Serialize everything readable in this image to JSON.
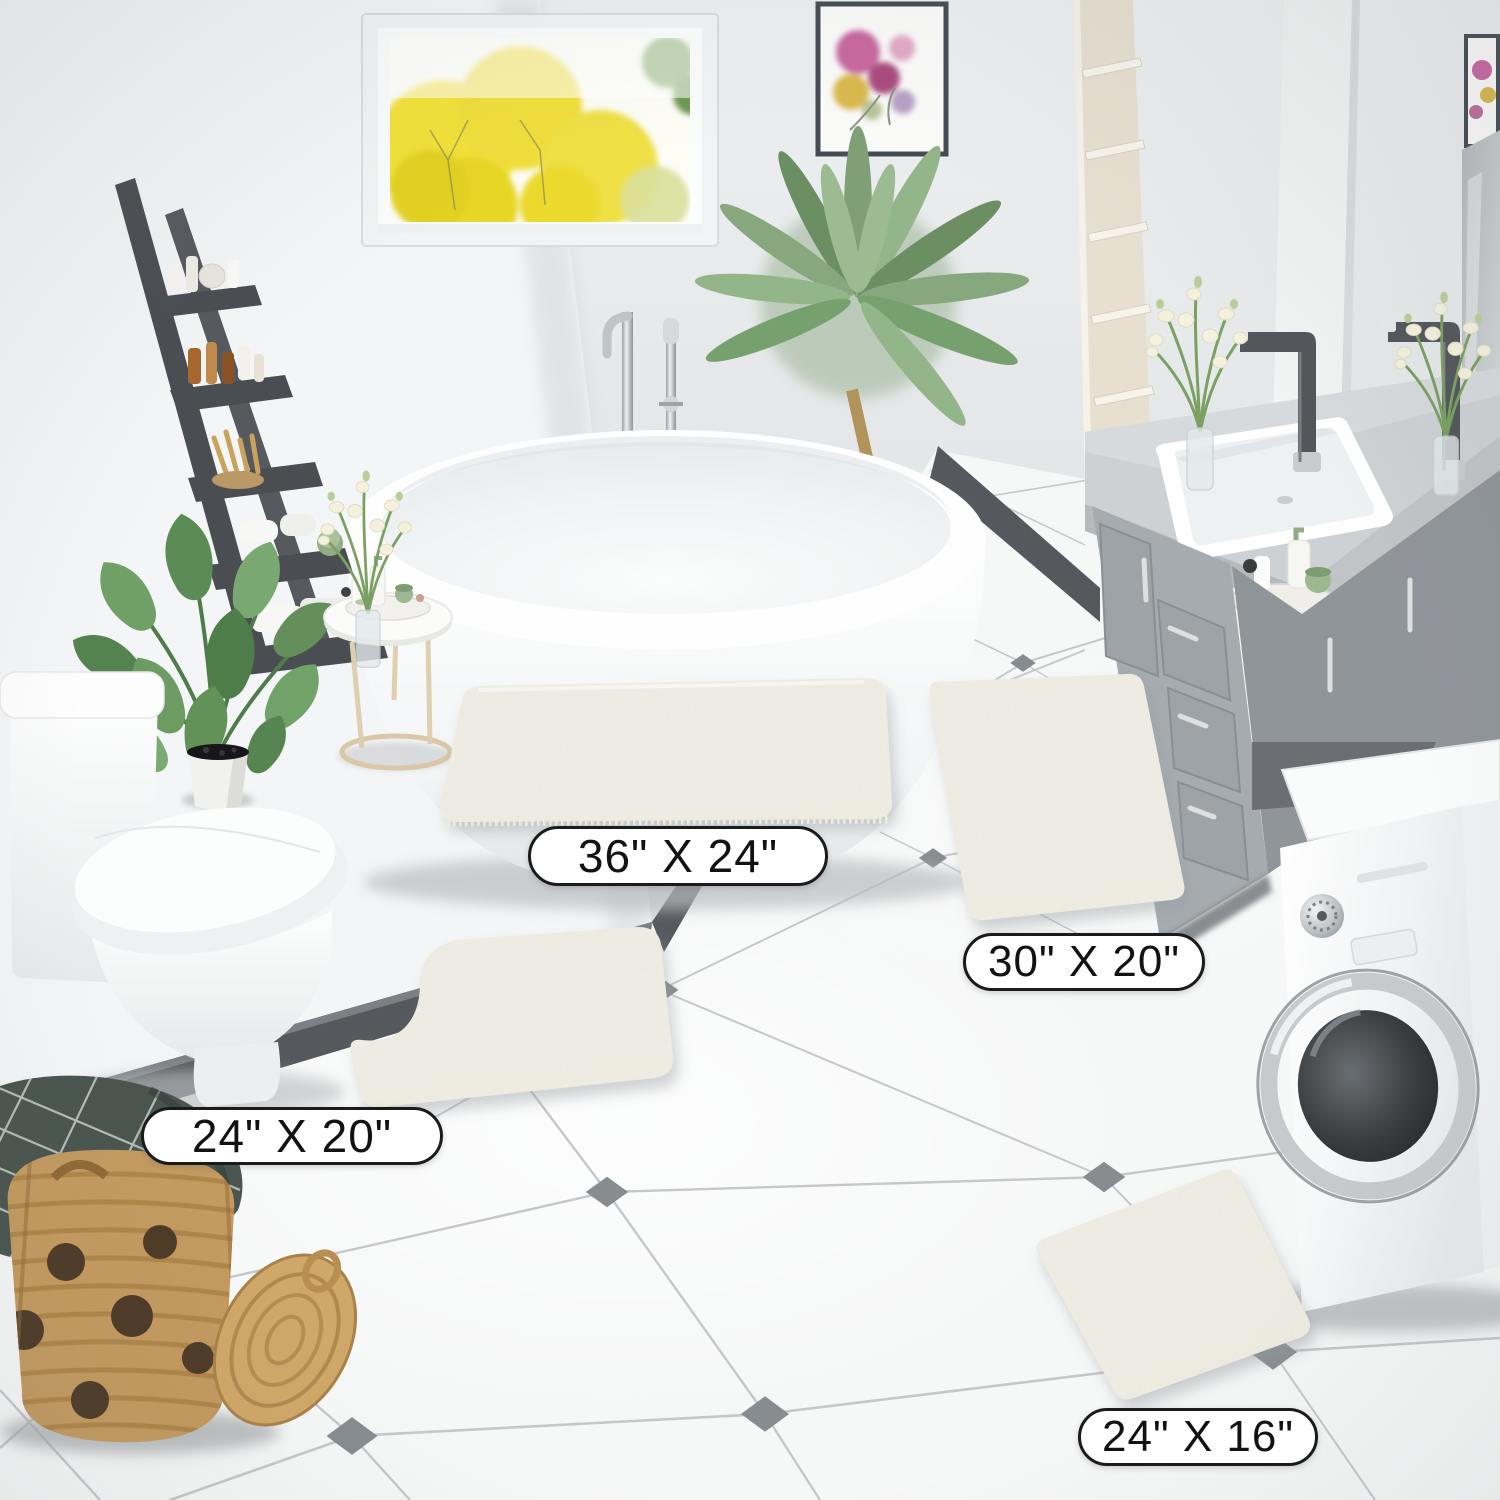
{
  "labels": {
    "rug_sizes": [
      {
        "rug": "large-rectangle-rug",
        "size_label": "36\" X 24\""
      },
      {
        "rug": "runner-rug",
        "size_label": "30\" X 20\""
      },
      {
        "rug": "contour-u-shape-rug",
        "size_label": "24\" X 20\""
      },
      {
        "rug": "small-rectangle-rug",
        "size_label": "24\" X 16\""
      }
    ]
  },
  "colors": {
    "label_bg": "#ffffff",
    "label_border": "#1b1b1b",
    "label_text": "#121212",
    "rug": "#f3f1e8",
    "wall": "#e4e6e8",
    "left_wall": "#f4f5f6",
    "baseboard": "#55595d",
    "floor": "#f6f7f7",
    "tile_line": "#c5c8ca",
    "tile_diamond": "#878c90",
    "vanity": "#a6abaf",
    "counter": "#cdd1d3",
    "faucet": "#53575b",
    "ladder": "#4a4e52",
    "basket": "#c39a60",
    "plant": "#6f9a67",
    "window_foliage": "#f0df38"
  }
}
